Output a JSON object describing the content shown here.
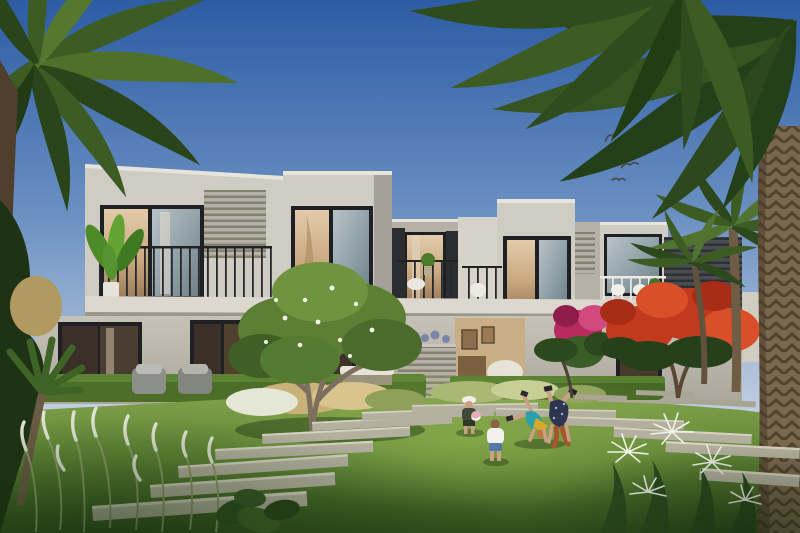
{
  "scene": {
    "type": "architectural-render",
    "description": "Daytime rendering of a row of modern two-storey white townhouses with balconies, glass facades and louvered panels, fronted by a landscaped lawn with a staggered stepping-stone path, a central frangipani tree, a red flame tree, palm trees framing both sides, four children playing on the grass and birds flying in a blue sky",
    "setting": "residential garden, sunny day",
    "palette": {
      "sky_top": "#2d5ca5",
      "sky_mid": "#6b90c2",
      "sky_horizon": "#c9d5e4",
      "facade_light": "#cfccc3",
      "facade_mid": "#bcb8ae",
      "facade_shade": "#a5a198",
      "slab_white": "#ddd9d0",
      "window_frame": "#1e2023",
      "glass_cool": "#9fb0b8",
      "glass_warm": "#d3b897",
      "louver_gray": "#9b978c",
      "dark_wall": "#3e4143",
      "hedge_green": "#4c6e28",
      "lawn_light": "#7fa04a",
      "lawn_mid": "#567c30",
      "lawn_dark": "#24401500",
      "lawn_shadow": "#1d3512",
      "stone": "#b4b0a0",
      "stone_highlight": "#d6d2c2",
      "palm_dark": "#24401a",
      "palm_mid": "#3c5c24",
      "palm_light": "#5d7f33",
      "trunk_brown": "#7a684e",
      "trunk_shadow": "#52432f",
      "flame_red": "#c23a1d",
      "flame_red_dark": "#97270f",
      "bougainvillea_pink": "#b62a5e",
      "blossom_white": "#f0f2e8",
      "grass_plume": "#dfe2d2",
      "skin": "#caa184",
      "kid_teal_shirt": "#2aa0a8",
      "kid_yellow_shorts": "#d9a928",
      "kid_floral_dark": "#2e3550",
      "kid_white_tee": "#f2f1ec",
      "kid_denim": "#5578a8",
      "kid_olive": "#3e4a36",
      "ball_pink": "#e9aebc",
      "bird_dark": "#4a4a4a",
      "interior_warm": "#c9a876",
      "interior_dark": "#33291f"
    },
    "objects": {
      "birds": {
        "count": 4,
        "area": "upper right sky"
      },
      "palm_left": {
        "label": "date palm crown",
        "area": "top left corner"
      },
      "palm_right_canopy": {
        "label": "overhanging palm fronds",
        "area": "top right"
      },
      "palm_right_trunk": {
        "label": "thick palm trunk",
        "area": "right edge"
      },
      "townhouse_blocks": {
        "count": 5,
        "storeys": 2,
        "features": [
          "balconies",
          "black metal railings",
          "white railings",
          "floor-to-ceiling glazing",
          "louvered panels",
          "roof parapets"
        ]
      },
      "frangipani_tree": {
        "label": "white-flowering tree",
        "area": "center midground"
      },
      "flame_tree": {
        "label": "red royal poinciana",
        "area": "right midground"
      },
      "magenta_shrub": {
        "label": "magenta bougainvillea shrub",
        "area": "right of patio"
      },
      "balcony_plant": {
        "label": "banana plant on left balcony"
      },
      "stepping_stones": {
        "count": 16,
        "label": "staggered plank pavers crossing lawn"
      },
      "children": [
        {
          "label": "child with white hat holding pink ball"
        },
        {
          "label": "toddler in white tee and denim shorts"
        },
        {
          "label": "child cartwheeling in teal top and yellow shorts"
        },
        {
          "label": "child doing handstand in dark floral outfit"
        }
      ],
      "foreground_plants": [
        "white plume grasses",
        "white crinum lilies",
        "fan palm",
        "leafy shrubs"
      ],
      "garden_furniture": [
        "grey outdoor armchairs",
        "white cushioned bench",
        "louvered planter box"
      ]
    }
  }
}
